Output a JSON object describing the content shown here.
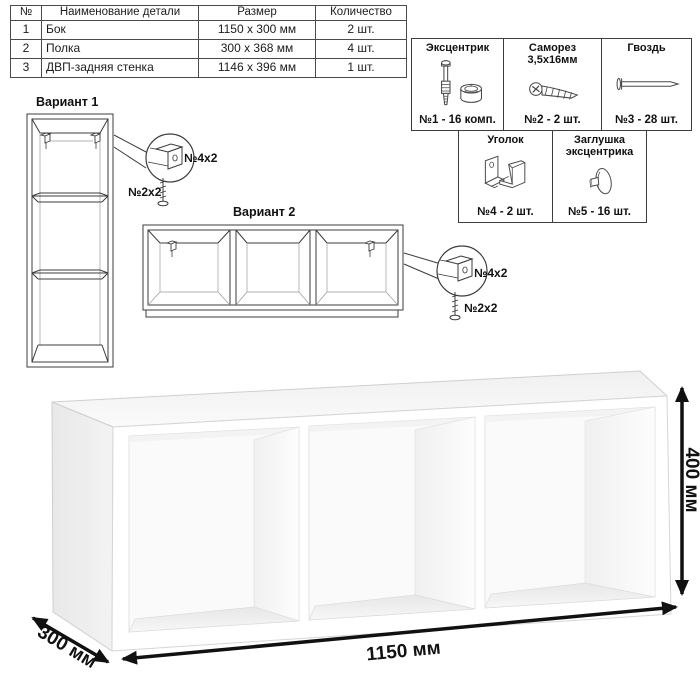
{
  "parts_table": {
    "headers": [
      "№",
      "Наименование детали",
      "Размер",
      "Количество"
    ],
    "rows": [
      {
        "num": "1",
        "name": "Бок",
        "size": "1150 x 300 мм",
        "qty": "2 шт."
      },
      {
        "num": "2",
        "name": "Полка",
        "size": "300 x 368 мм",
        "qty": "4 шт."
      },
      {
        "num": "3",
        "name": "ДВП-задняя стенка",
        "size": "1146 x 396 мм",
        "qty": "1 шт."
      }
    ]
  },
  "hardware": {
    "items": [
      {
        "name": "Эксцентрик",
        "name2": "",
        "count": "№1 - 16 комп.",
        "icon": "eccentric-cam-icon"
      },
      {
        "name": "Саморез",
        "name2": "3,5х16мм",
        "count": "№2 - 2 шт.",
        "icon": "self-tapping-screw-icon"
      },
      {
        "name": "Гвоздь",
        "name2": "",
        "count": "№3 - 28 шт.",
        "icon": "nail-icon"
      },
      {
        "name": "Уголок",
        "name2": "",
        "count": "№4 - 2 шт.",
        "icon": "corner-bracket-icon"
      },
      {
        "name": "Заглушка",
        "name2": "эксцентрика",
        "count": "№5 - 16 шт.",
        "icon": "cam-cap-icon"
      }
    ]
  },
  "variants": {
    "variant1": {
      "label": "Вариант 1",
      "bracket_label": "№4х2",
      "screw_label": "№2х2"
    },
    "variant2": {
      "label": "Вариант 2",
      "bracket_label": "№4х2",
      "screw_label": "№2х2"
    }
  },
  "dimensions": {
    "width_label": "1150 мм",
    "height_label": "400 мм",
    "depth_label": "300 мм"
  },
  "colors": {
    "line": "#3c3c3c",
    "dim_arrow": "#111111",
    "shade_light": "#ededed",
    "shade_top": "#f4f4f4"
  }
}
